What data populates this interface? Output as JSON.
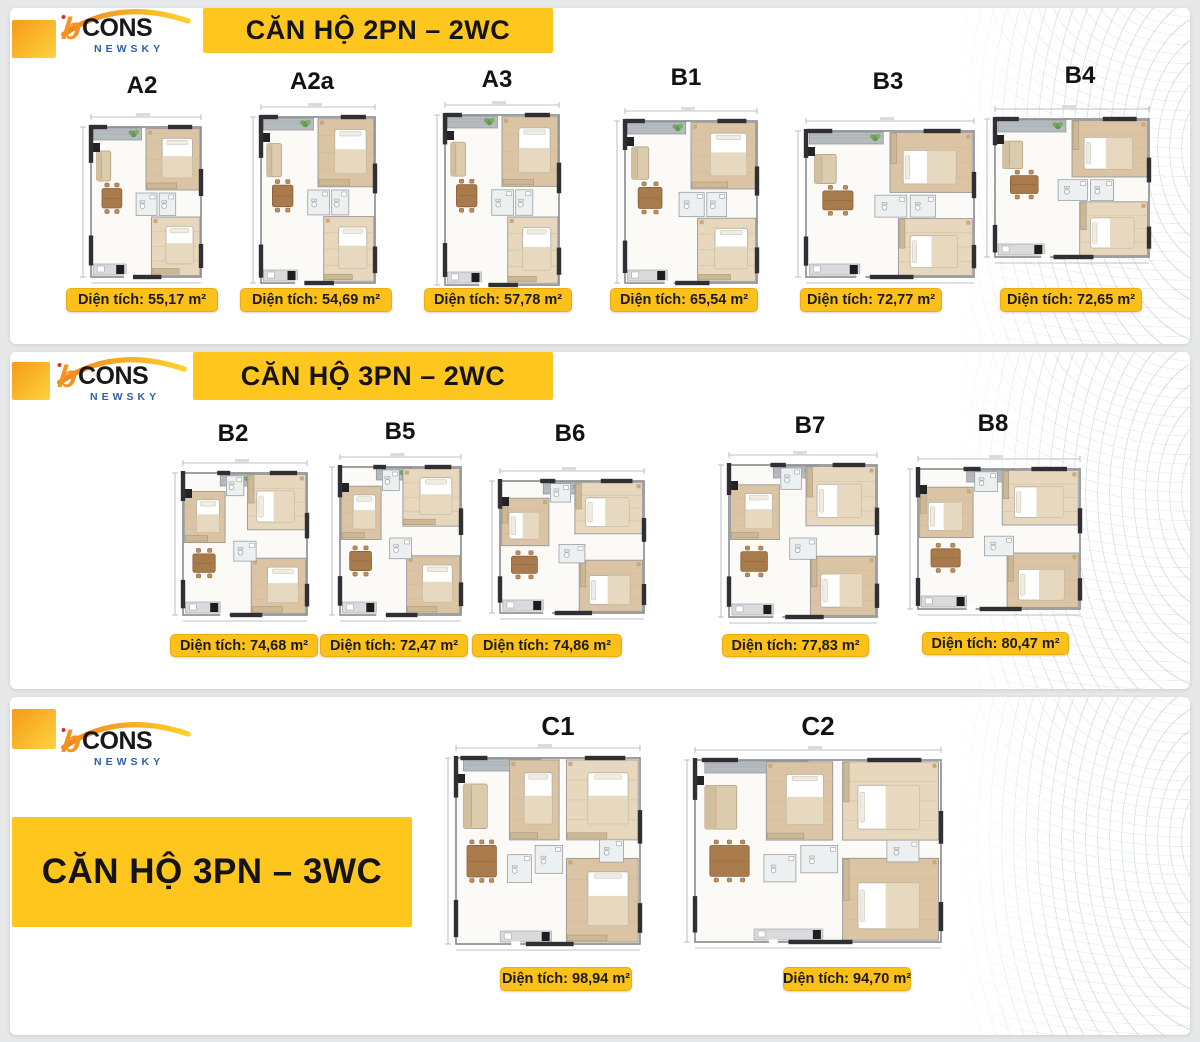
{
  "brand": {
    "b": "b",
    "name": "CONS",
    "sub": "NEWSKY"
  },
  "colors": {
    "banner_yellow": "#ffc61e",
    "badge_yellow": "#fcc01a",
    "logo_orange": "#f6921e",
    "logo_blue": "#2e5fa8",
    "page_background": "#e7e8ea"
  },
  "sections": [
    {
      "banner": "CĂN HỘ 2PN – 2WC",
      "plans": [
        {
          "code": "A2",
          "area_text": "Diện tích: 55,17 m²"
        },
        {
          "code": "A2a",
          "area_text": "Diện tích: 54,69 m²"
        },
        {
          "code": "A3",
          "area_text": "Diện tích: 57,78 m²"
        },
        {
          "code": "B1",
          "area_text": "Diện tích: 65,54 m²"
        },
        {
          "code": "B3",
          "area_text": "Diện tích: 72,77 m²"
        },
        {
          "code": "B4",
          "area_text": "Diện tích: 72,65 m²"
        }
      ]
    },
    {
      "banner": "CĂN HỘ 3PN – 2WC",
      "plans": [
        {
          "code": "B2",
          "area_text": "Diện tích: 74,68 m²"
        },
        {
          "code": "B5",
          "area_text": "Diện tích: 72,47 m²"
        },
        {
          "code": "B6",
          "area_text": "Diện tích: 74,86 m²"
        },
        {
          "code": "B7",
          "area_text": "Diện tích: 77,83 m²"
        },
        {
          "code": "B8",
          "area_text": "Diện tích: 80,47 m²"
        }
      ]
    },
    {
      "banner": "CĂN HỘ 3PN – 3WC",
      "plans": [
        {
          "code": "C1",
          "area_text": "Diện tích: 98,94 m²"
        },
        {
          "code": "C2",
          "area_text": "Diện tích: 94,70 m²"
        }
      ]
    }
  ]
}
